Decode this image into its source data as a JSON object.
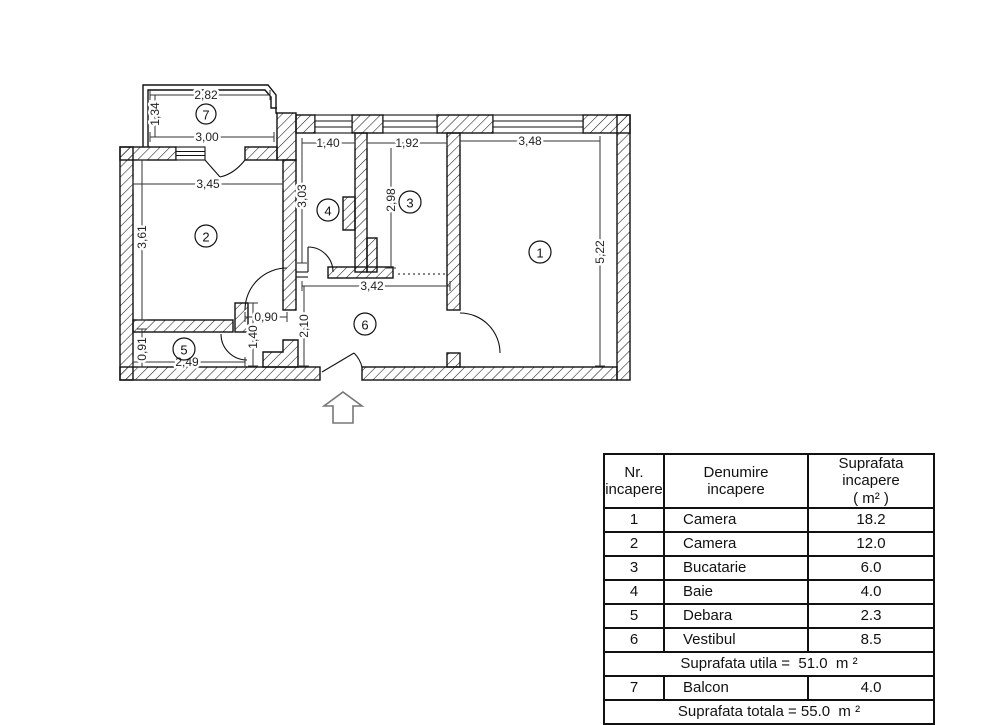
{
  "floor_plan": {
    "rooms": [
      {
        "number": "1"
      },
      {
        "number": "2"
      },
      {
        "number": "3"
      },
      {
        "number": "4"
      },
      {
        "number": "5"
      },
      {
        "number": "6"
      },
      {
        "number": "7"
      }
    ],
    "dimensions": {
      "balcony_width": "2,82",
      "balcony_depth": "1,34",
      "balcony_bottom": "3,00",
      "room2_width": "3,45",
      "room2_height": "3,61",
      "room5_height": "0,91",
      "room5_width": "2,49",
      "room4_width": "1,40",
      "room3_width": "1,92",
      "room1_width": "3,48",
      "room4_height": "3,03",
      "room3_height": "2,98",
      "room1_height": "5,22",
      "vestibule_width": "3,42",
      "door_width": "0,90",
      "vestibule_height": "2,10",
      "nook_height": "1,40"
    }
  },
  "table": {
    "headers": [
      "Nr.\nincapere",
      "Denumire\nincapere",
      "Suprafata incapere\n( m² )"
    ],
    "rows": [
      {
        "nr": "1",
        "name": "Camera",
        "area": "18.2"
      },
      {
        "nr": "2",
        "name": "Camera",
        "area": "12.0"
      },
      {
        "nr": "3",
        "name": "Bucatarie",
        "area": "6.0"
      },
      {
        "nr": "4",
        "name": "Baie",
        "area": "4.0"
      },
      {
        "nr": "5",
        "name": "Debara",
        "area": "2.3"
      },
      {
        "nr": "6",
        "name": "Vestibul",
        "area": "8.5"
      }
    ],
    "suprafata_utila": "Suprafata utila =  51.0  m ²",
    "balcony_row": {
      "nr": "7",
      "name": "Balcon",
      "area": "4.0"
    },
    "suprafata_totala": "Suprafata totala = 55.0  m ²"
  }
}
